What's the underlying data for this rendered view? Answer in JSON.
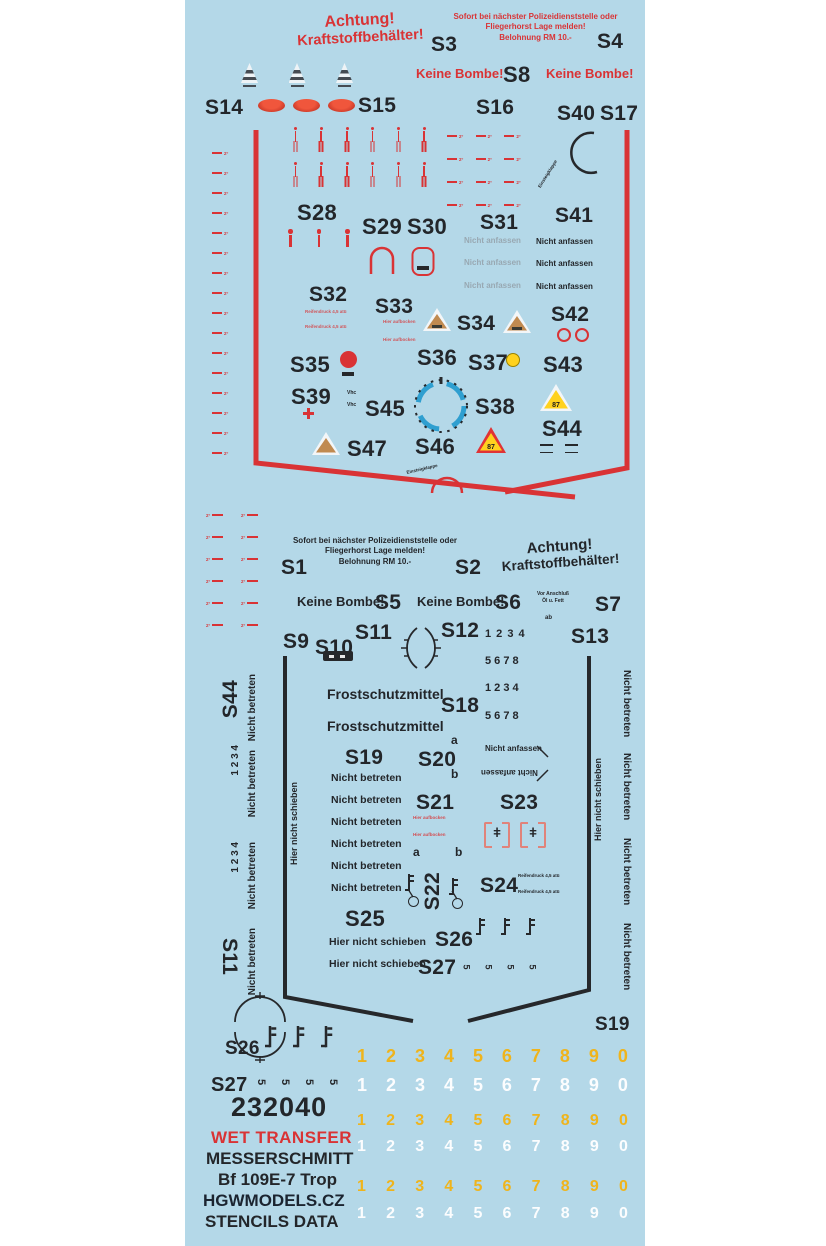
{
  "colors": {
    "sheet_background": "#b4d8e8",
    "stencil_red": "#d93335",
    "stencil_black": "#23262a",
    "faded_gray": "#98a8b2",
    "digit_yellow": "#efb41c",
    "digit_white": "#fcfdfe",
    "tan_triangle": "#c08a50",
    "warning_yellow": "#ffd21e",
    "dial_blue": "#2f9fd0"
  },
  "labels": {
    "s1": "S1",
    "s2": "S2",
    "s3": "S3",
    "s4": "S4",
    "s5": "S5",
    "s6": "S6",
    "s7": "S7",
    "s8": "S8",
    "s9": "S9",
    "s10": "S10",
    "s11": "S11",
    "s12": "S12",
    "s13": "S13",
    "s14": "S14",
    "s15": "S15",
    "s16": "S16",
    "s17": "S17",
    "s18": "S18",
    "s19": "S19",
    "s20": "S20",
    "s21": "S21",
    "s22": "S22",
    "s23": "S23",
    "s24": "S24",
    "s25": "S25",
    "s26": "S26",
    "s27": "S27",
    "s28": "S28",
    "s29": "S29",
    "s30": "S30",
    "s31": "S31",
    "s32": "S32",
    "s33": "S33",
    "s34": "S34",
    "s35": "S35",
    "s36": "S36",
    "s37": "S37",
    "s38": "S38",
    "s39": "S39",
    "s40": "S40",
    "s41": "S41",
    "s42": "S42",
    "s43": "S43",
    "s44": "S44",
    "s45": "S45",
    "s46": "S46",
    "s47": "S47"
  },
  "strings": {
    "achtung": "Achtung!",
    "kraftstoffbehaelter": "Kraftstoffbehälter!",
    "sofort_line1": "Sofort bei nächster Polizeidienststelle oder",
    "sofort_line2": "Fliegerhorst Lage melden!",
    "sofort_line3": "Belohnung RM 10.-",
    "keine_bombe": "Keine Bombe!",
    "nicht_anfassen": "Nicht anfassen",
    "nicht_betreten": "Nicht betreten",
    "hier_nicht_schieben": "Hier nicht schieben",
    "frostschutzmittel": "Frostschutzmittel",
    "vor_anschluss_line1": "Vor Anschluß",
    "vor_anschluss_line2": "Öl u. Fett",
    "ab": "ab",
    "reifendruck": "Reifendruck 4,5 atü",
    "hier_aufbocken": "Hier aufbocken",
    "einsteigklappe": "Einsteigklappe",
    "vhc": "Vhc",
    "a": "a",
    "b": "b",
    "octane_87": "87",
    "row_1_4": "1  2  3  4",
    "row_5_8": "5  6  7  8"
  },
  "icons": {
    "valve_glyph": "ǂ",
    "rotated_s_glyph": "5",
    "deg_mark": "2°"
  },
  "marks": {
    "trim_left_count": 16,
    "grid_count": 12,
    "match_per_row": 6,
    "i_count": 3,
    "z_per_col": 6,
    "fuel_triangle_count": 3,
    "oval_count": 3
  },
  "digits": [
    "1",
    "2",
    "3",
    "4",
    "5",
    "6",
    "7",
    "8",
    "9",
    "0"
  ],
  "footer": {
    "code": "232040",
    "type": "WET TRANSFER",
    "maker": "MESSERSCHMITT",
    "aircraft": "Bf 109E-7 Trop",
    "brand": "HGWMODELS.CZ",
    "series": "STENCILS  DATA"
  }
}
